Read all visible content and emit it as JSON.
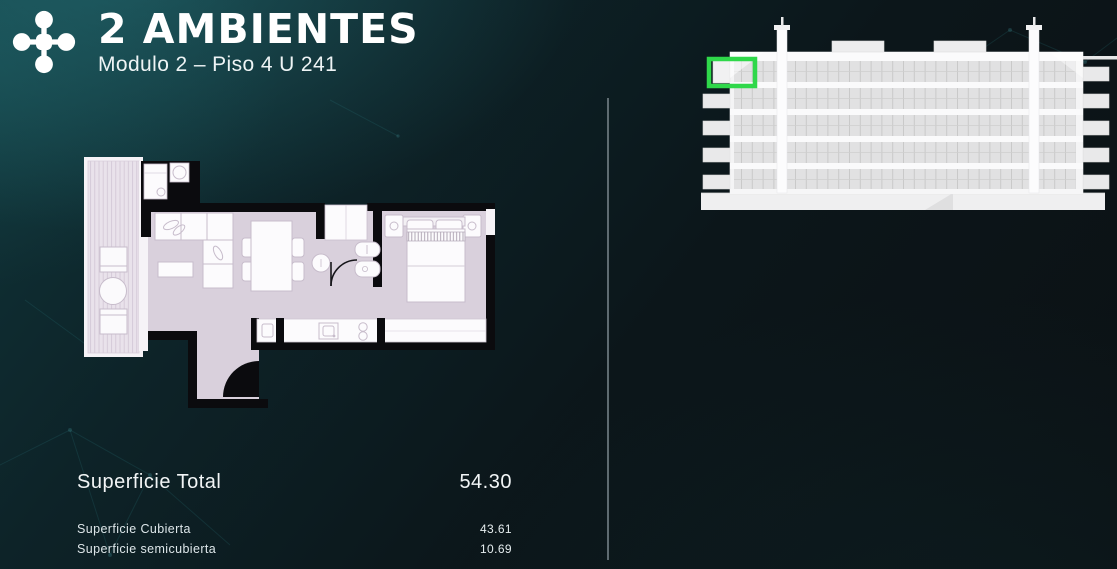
{
  "header": {
    "logo_icon": "molecule-cross-logo",
    "title": "2 AMBIENTES",
    "subtitle": "Modulo 2 – Piso 4 U 241"
  },
  "summary": {
    "total_label": "Superficie Total",
    "total_value": "54.30",
    "details": [
      {
        "label": "Superficie Cubierta",
        "value": "43.61"
      },
      {
        "label": "Superficie semicubierta",
        "value": "10.69"
      }
    ]
  },
  "floor_plan": {
    "graphic": "apartment-floor-plan",
    "floor_color": "#d9d0dc",
    "balcony_color": "#e9e2eb",
    "wall_color": "#0b0b0e"
  },
  "elevation": {
    "graphic": "building-side-elevation",
    "visible_floors": 5,
    "unit_highlight_color": "#2fd84a"
  },
  "theme": {
    "background_teal": "#10353a",
    "text_color": "#f2f5f6",
    "divider_color": "#6e7a80"
  }
}
